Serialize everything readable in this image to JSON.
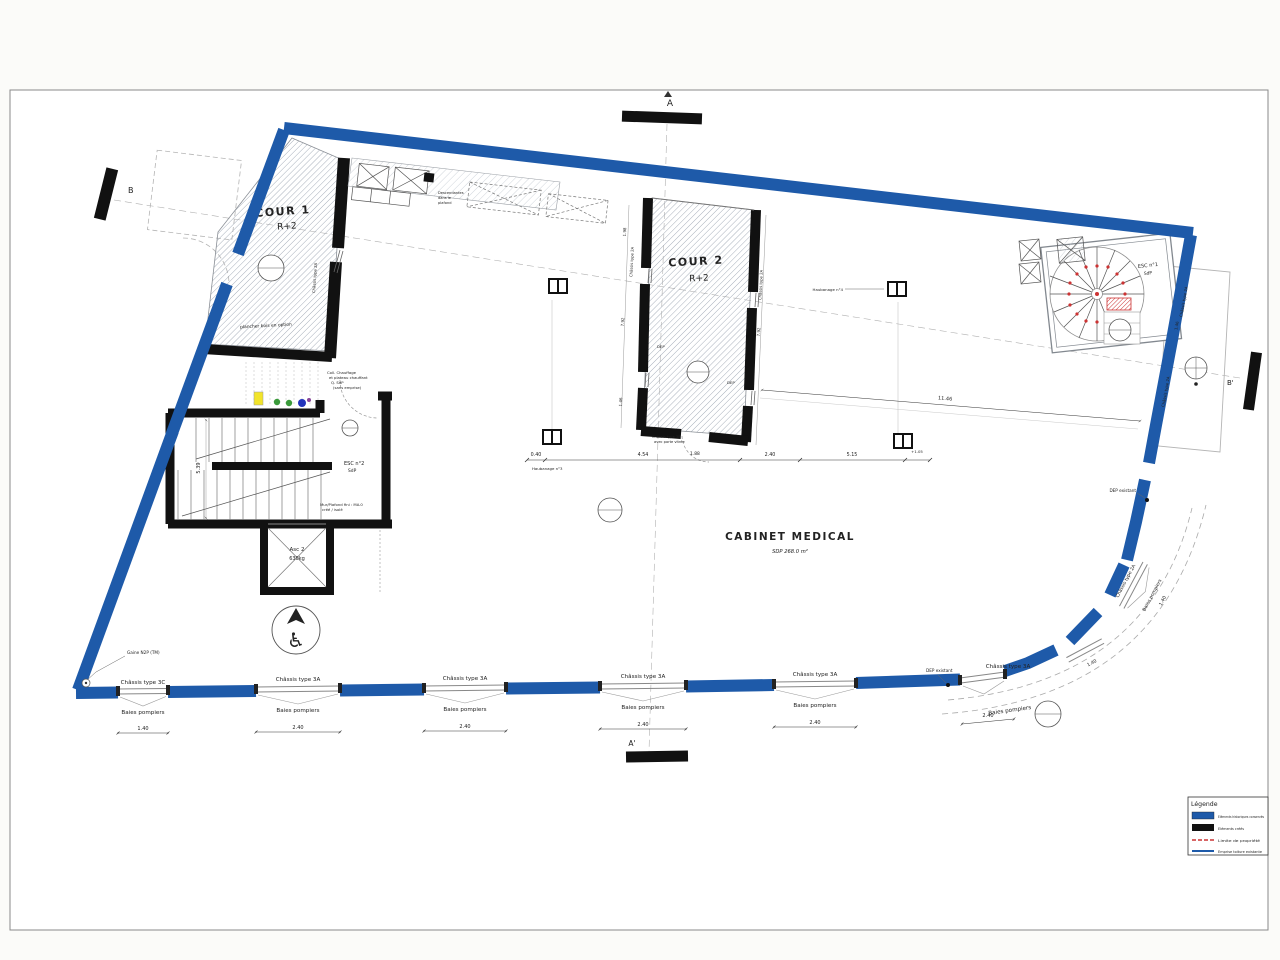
{
  "sheet": {
    "bg": "#ffffff",
    "frame_color": "#8a8a8a"
  },
  "colors": {
    "historic_blue": "#1e5aa9",
    "created_black": "#111111",
    "property_red": "#cc3333"
  },
  "section_markers": {
    "a": "A",
    "a_prime": "A'",
    "b": "B",
    "b_prime": "B'"
  },
  "rooms": {
    "cour1": {
      "name": "COUR 1",
      "level": "R+2",
      "floor_note": "plancher bois en option"
    },
    "cour2": {
      "name": "COUR 2",
      "level": "R+2",
      "dep_left": "DEP",
      "dep_right": "DEP",
      "door_note_1": "Châssis type 3B",
      "door_note_2": "avec porte vitrée",
      "door_dim": "1.88"
    },
    "cabinet": {
      "name": "CABINET MEDICAL",
      "area": "SDP 268.0 m²"
    },
    "esc1": {
      "name": "ESC n°1",
      "sub": "SdP"
    },
    "esc2": {
      "name": "ESC n°2",
      "sub": "SdP"
    },
    "asc": {
      "name": "Asc 2",
      "load": "630kg"
    }
  },
  "windows": {
    "type_3c": "Châssis type 3C",
    "type_3a": "Châssis type 3A",
    "type_2a": "Châssis type 2A",
    "baies": "Baies pompiers"
  },
  "annotations": {
    "gaine": "Gaine N2P (TM)",
    "dep_existant": "DEP existant",
    "descendantes_1": "Descendantes",
    "descendantes_2": "dans le",
    "descendantes_3": "plafond",
    "coll_1": "Coll. Chauffage",
    "coll_2": "et plateau chauffant",
    "coll_3": "Q. SdP",
    "coll_4": "(sans emprise)",
    "mur_1": "Mur/Plafond fini : MA.0",
    "mur_2": "créé / isolé",
    "haubanage_3": "Haubanage n°3",
    "haubanage_4": "Haubanage n°4"
  },
  "dimensions": {
    "d_040": "0.40",
    "d_454": "4.54",
    "d_240": "2.40",
    "d_515": "5.15",
    "d_105": "+1.05",
    "d_1146": "11.46",
    "d_140": "1.40",
    "d_188": "1.88",
    "d_539": "5.39",
    "d_198": "1.98",
    "d_792": "7.92",
    "d_146": "1.46"
  },
  "legend": {
    "title": "Légende",
    "items": [
      {
        "label": "Eléments historiques conservés",
        "swatch": "solid-blue"
      },
      {
        "label": "Eléments créés",
        "swatch": "solid-black"
      },
      {
        "label": "Limite de propriété",
        "swatch": "red-dash"
      },
      {
        "label": "Emprise toiture existante",
        "swatch": "blue-line"
      }
    ]
  }
}
